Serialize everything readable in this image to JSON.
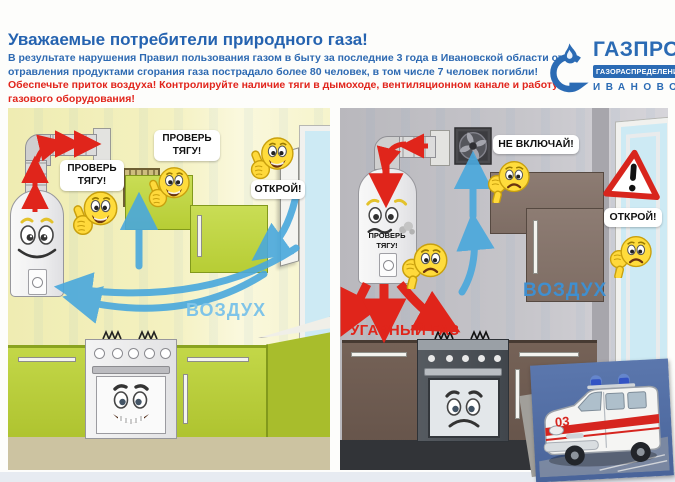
{
  "header": {
    "title": "Уважаемые потребители природного газа!",
    "body": "В результате нарушения Правил пользования газом в быту за последние 3 года в Ивановской области от отравления продуктами сгорания газа пострадало более 80 человек, в том числе 7 человек погибли!",
    "warning": "Обеспечьте приток воздуха! Контролируйте наличие тяги в дымоходе, вентиляционном канале и работу газового оборудования!"
  },
  "logo": {
    "brand": "ГАЗПРОМ",
    "division": "ГАЗОРАСПРЕДЕЛЕНИЕ",
    "city": "ИВАНОВО"
  },
  "left_panel": {
    "label_check_draft_heater": "ПРОВЕРЬ ТЯГУ!",
    "label_check_draft_vent": "ПРОВЕРЬ ТЯГУ!",
    "label_open_window": "ОТКРОЙ!",
    "label_air": "ВОЗДУХ"
  },
  "right_panel": {
    "label_check_draft": "ПРОВЕРЬ ТЯГУ!",
    "label_dont_switch_on": "НЕ ВКЛЮЧАЙ!",
    "label_open_window": "ОТКРОЙ!",
    "label_air": "ВОЗДУХ",
    "label_carbon_monoxide": "УГАРНЫЙ ГАЗ",
    "ambulance_number": "03"
  },
  "colors": {
    "brand_blue": "#2b6bb4",
    "warning_red": "#e0251b",
    "air_blue_light": "#7fc4e8",
    "air_blue": "#3f8fd0",
    "safe_lime": "#b7cd35",
    "danger_brown": "#7e6d64"
  }
}
